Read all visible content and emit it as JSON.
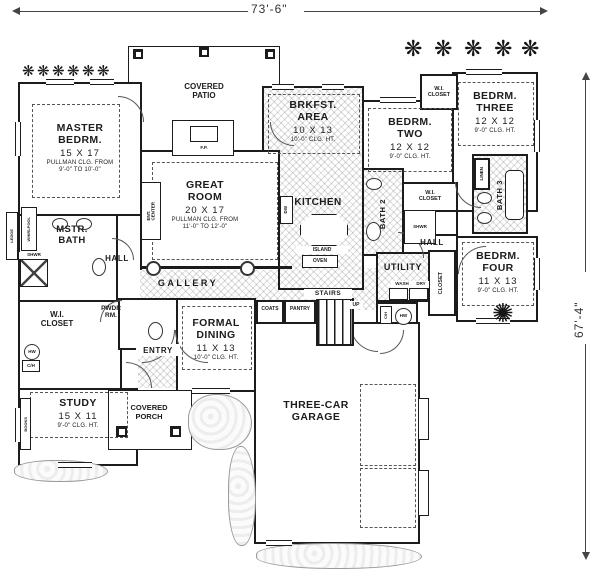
{
  "dimensions": {
    "overall_width": "73'-6\"",
    "overall_height": "67'-4\""
  },
  "rooms": {
    "master_bedroom": {
      "name": "MASTER\nBEDRM.",
      "size": "15 X 17",
      "note": "PULLMAN CLG. FROM\n9'-0\" TO 10'-0\""
    },
    "covered_patio": {
      "name": "COVERED\nPATIO"
    },
    "brkfst_area": {
      "name": "BRKFST.\nAREA",
      "size": "10 X 13",
      "note": "10'-0\" CLG. HT."
    },
    "bedroom_two": {
      "name": "BEDRM.\nTWO",
      "size": "12 X 12",
      "note": "9'-0\" CLG. HT."
    },
    "bedroom_three": {
      "name": "BEDRM.\nTHREE",
      "size": "12 X 12",
      "note": "9'-0\" CLG. HT."
    },
    "great_room": {
      "name": "GREAT\nROOM",
      "size": "20 X 17",
      "note": "PULLMAN CLG. FROM\n11'-0\" TO 12'-0\""
    },
    "kitchen": {
      "name": "KITCHEN"
    },
    "master_bath": {
      "name": "MSTR.\nBATH"
    },
    "hall_left": {
      "name": "HALL"
    },
    "hall_right": {
      "name": "HALL"
    },
    "wi_closet_master": {
      "name": "W.I.\nCLOSET"
    },
    "wi_closet_bed2": {
      "name": "W.I.\nCLOSET"
    },
    "wi_closet_bed3": {
      "name": "W.I.\nCLOSET"
    },
    "powder_room": {
      "name": "PWDR\nRM."
    },
    "gallery": {
      "name": "GALLERY"
    },
    "bath_two": {
      "name": "BATH 2"
    },
    "bath_three": {
      "name": "BATH 3"
    },
    "linen": {
      "name": "LINEN"
    },
    "bedroom_four": {
      "name": "BEDRM.\nFOUR",
      "size": "11 X 13",
      "note": "9'-0\" CLG. HT."
    },
    "closet_bed4": {
      "name": "CLOSET"
    },
    "utility": {
      "name": "UTILITY"
    },
    "formal_dining": {
      "name": "FORMAL\nDINING",
      "size": "11 X 13",
      "note": "10'-0\" CLG. HT."
    },
    "entry": {
      "name": "ENTRY"
    },
    "covered_porch": {
      "name": "COVERED\nPORCH"
    },
    "study": {
      "name": "STUDY",
      "size": "15 X 11",
      "note": "9'-0\" CLG. HT."
    },
    "garage": {
      "name": "THREE-CAR\nGARAGE"
    }
  },
  "fixtures": {
    "fireplace": "F.P.",
    "ent_center": "ENT.\nCENTER",
    "whirlpool": "WHIRLPOOL",
    "ledge": "LEDGE",
    "shower_1": "SHWR",
    "shower_2": "SHWR",
    "books": "BOOKS",
    "island": "ISLAND",
    "oven": "OVEN",
    "dishwasher": "DW",
    "washer": "WASH",
    "dryer": "DRY",
    "coats": "COATS",
    "pantry": "PANTRY",
    "stairs": "STAIRS",
    "up": "UP",
    "ch_1": "C/H",
    "hw_1": "HW",
    "ch_2": "C/H",
    "hw_2": "HW"
  },
  "icons": {
    "shrub": "❋",
    "flower": "✺"
  },
  "colors": {
    "ink": "#1c1c1c",
    "hatch": "#bdbdbd",
    "paper": "#ffffff"
  }
}
